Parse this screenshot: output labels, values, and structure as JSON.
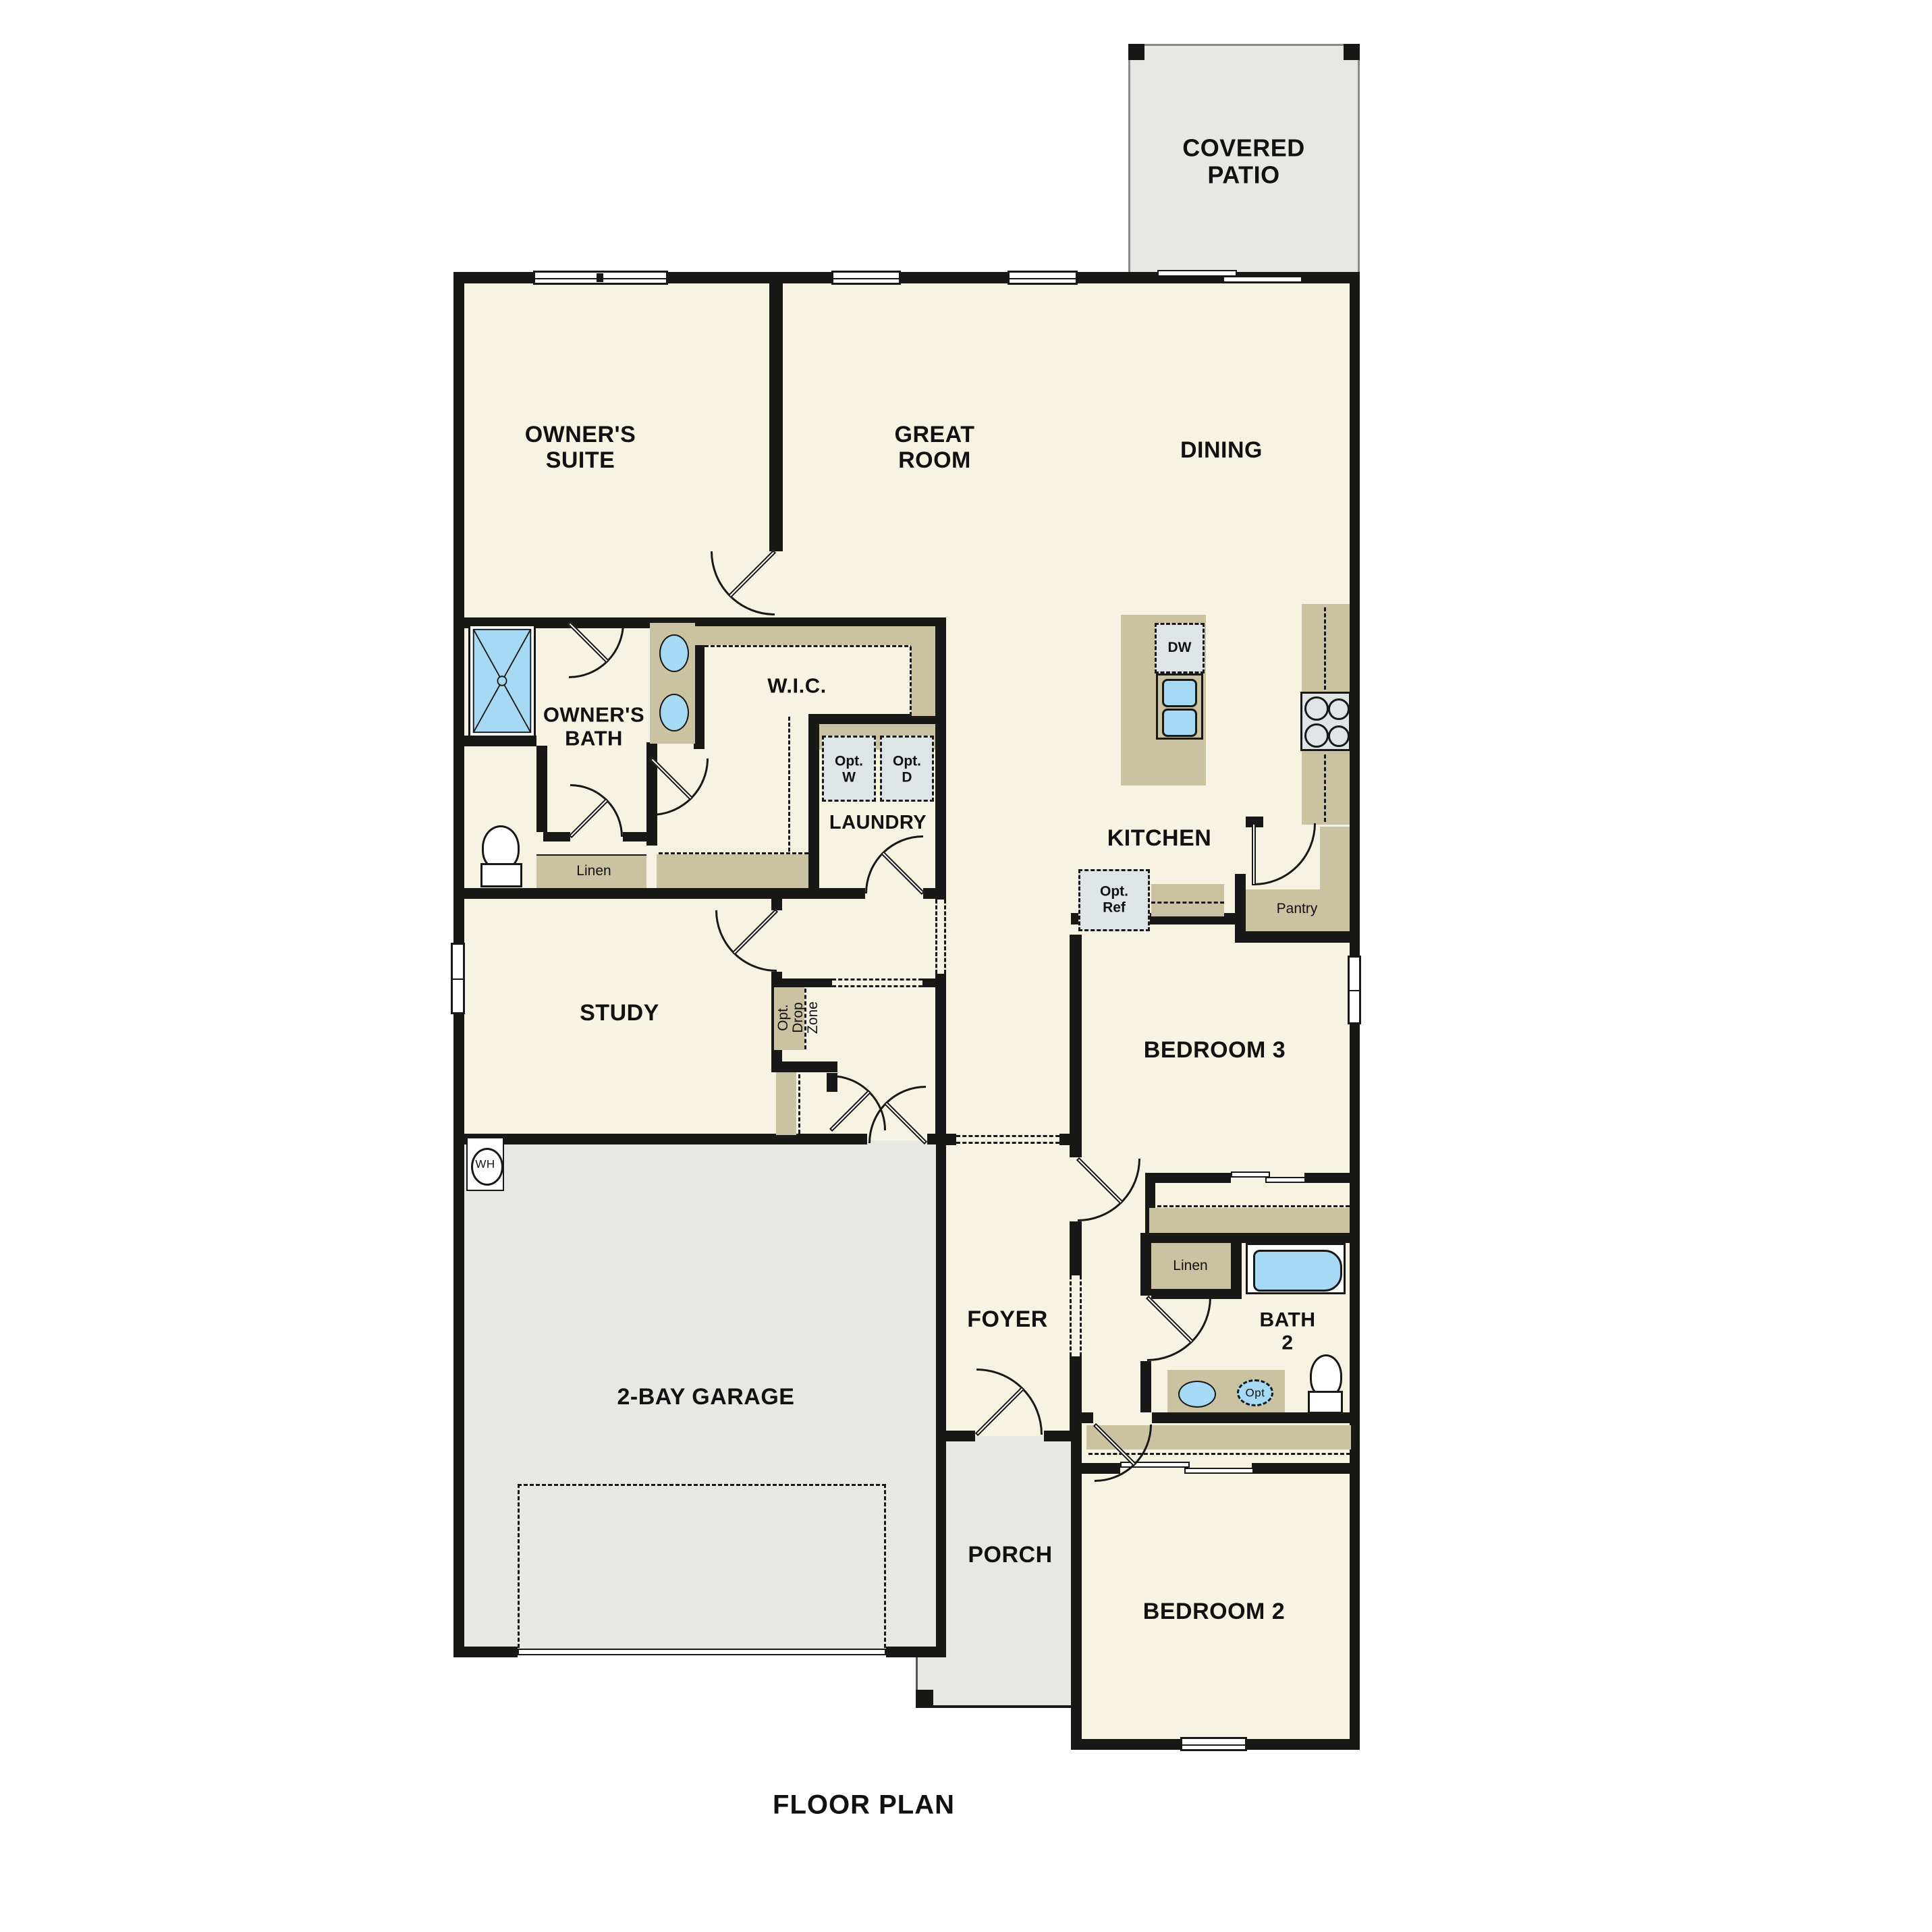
{
  "title": "FLOOR PLAN",
  "colors": {
    "floor": "#f7f3e3",
    "concrete": "#e7e7e4",
    "casework": "#cbc2a2",
    "appliance": "#dfe5e6",
    "fixture_blue": "#a6d9f4",
    "wall": "#181816"
  },
  "rooms": {
    "covered_patio": "COVERED\nPATIO",
    "owners_suite": "OWNER'S\nSUITE",
    "great_room": "GREAT\nROOM",
    "dining": "DINING",
    "owners_bath": "OWNER'S\nBATH",
    "wic": "W.I.C.",
    "laundry": "LAUNDRY",
    "kitchen": "KITCHEN",
    "study": "STUDY",
    "bedroom3": "BEDROOM 3",
    "foyer": "FOYER",
    "bath2": "BATH\n2",
    "garage": "2-BAY GARAGE",
    "porch": "PORCH",
    "bedroom2": "BEDROOM 2"
  },
  "fixtures": {
    "dw": "DW",
    "opt_w": "Opt.\nW",
    "opt_d": "Opt.\nD",
    "opt_ref": "Opt.\nRef",
    "pantry": "Pantry",
    "linen_owner": "Linen",
    "linen_hall": "Linen",
    "drop_zone": "Opt.\nDrop\nZone",
    "wh": "WH",
    "opt_sink": "Opt"
  }
}
